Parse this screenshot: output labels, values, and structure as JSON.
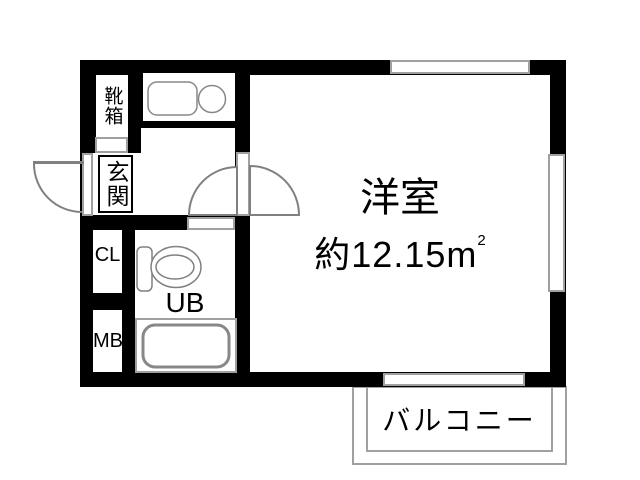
{
  "floorplan": {
    "main_room": {
      "label": "洋室",
      "area_prefix": "約12.15",
      "area_unit": "m",
      "area_exp": "2"
    },
    "balcony_label": "バルコニー",
    "entrance_label": "玄関",
    "shoe_box_label": "靴箱",
    "closet_label": "CL",
    "meter_box_label": "MB",
    "unit_bath_label": "UB"
  },
  "colors": {
    "wall": "#000000",
    "frame": "#a0a0a0",
    "fixture": "#808080",
    "text": "#000000",
    "background": "#ffffff"
  }
}
